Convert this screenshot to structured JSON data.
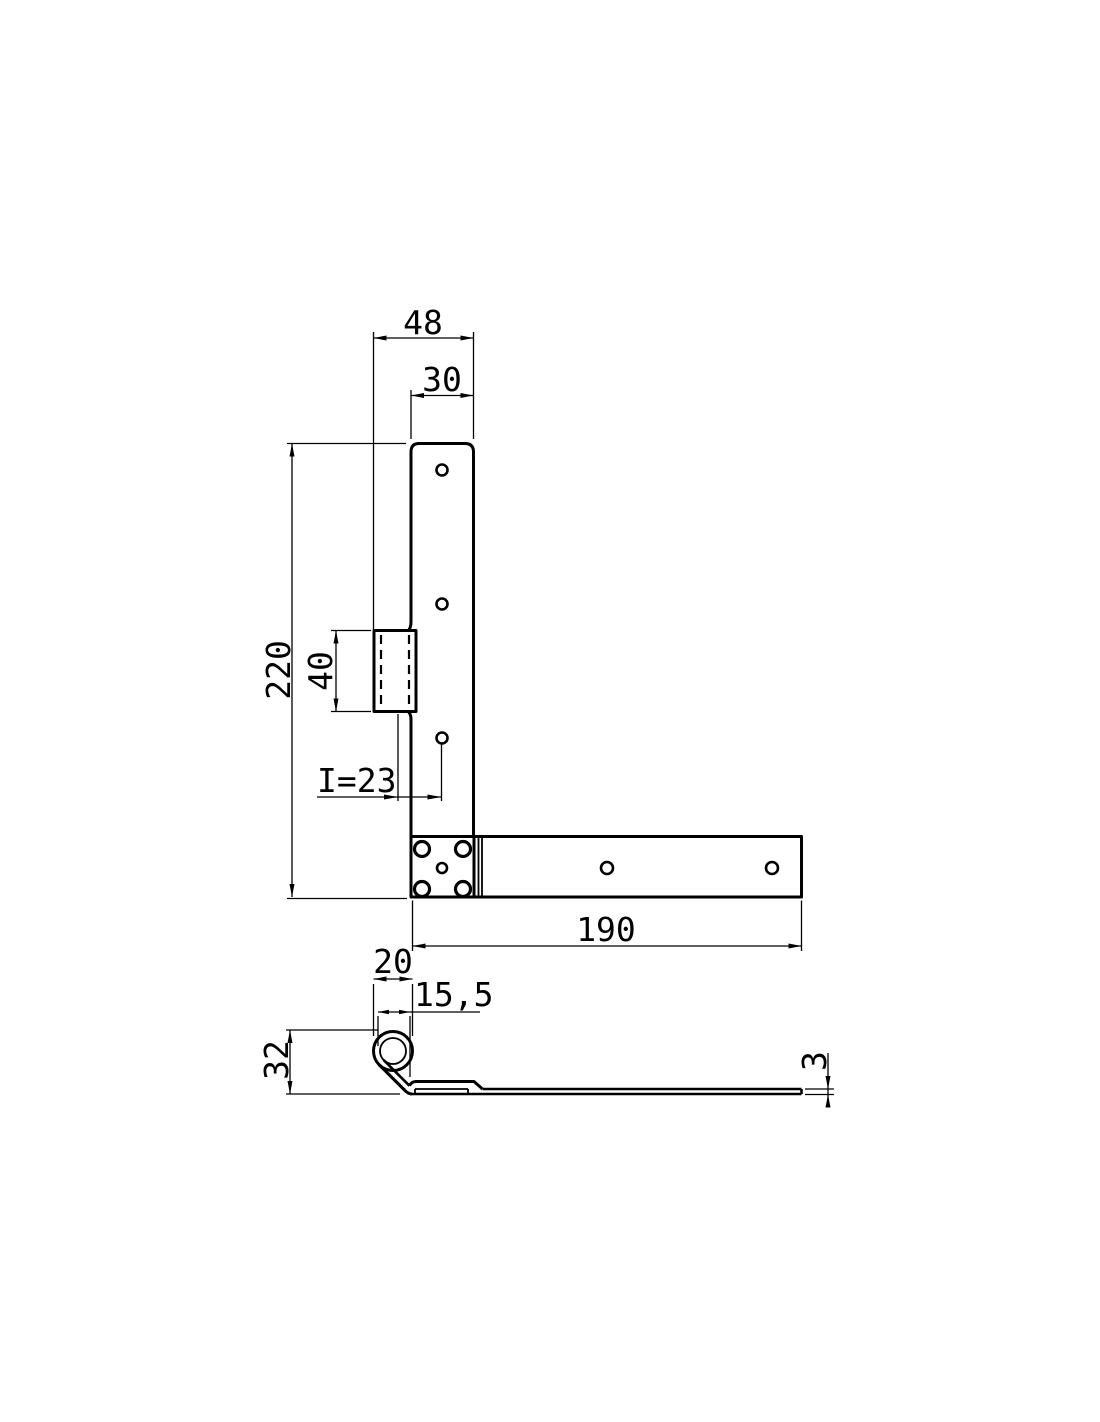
{
  "drawing": {
    "background_color": "#ffffff",
    "line_color": "#000000",
    "views": {
      "front": {
        "dimensions": {
          "overall_width": "48",
          "leaf_width": "30",
          "leaf_height": "220",
          "knuckle_length": "40",
          "hole_offset": "I=23",
          "strap_length": "190"
        }
      },
      "side": {
        "dimensions": {
          "barrel_width": "20",
          "barrel_offset": "15,5",
          "barrel_height": "32",
          "material_thickness": "3"
        }
      }
    }
  }
}
